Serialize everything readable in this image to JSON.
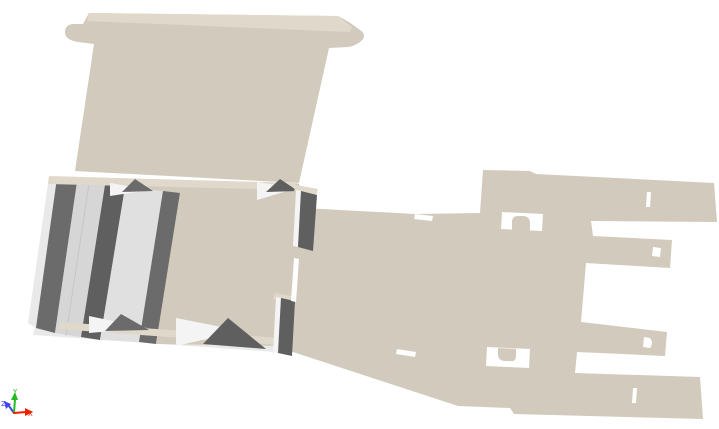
{
  "viewport": {
    "description": "3D visualization viewport showing a partially folded cardboard packaging blank on a white background",
    "background": "#ffffff",
    "object": "cardboard-box-blank-partially-folded"
  },
  "palette": {
    "board": "#d2cabc",
    "edgeBoard": "#e0d9cb",
    "edgeLight": "#e9e9e9",
    "wallDark": "#6b6b6b",
    "wallDark2": "#5f5f5f",
    "floorGray": "#d6d6d6",
    "floorGray2": "#e0e0e0",
    "white": "#ffffff",
    "white2": "#f4f4f4",
    "seam": "#c6c6c6",
    "axisX": "#ee2200",
    "axisY": "#22bb22",
    "axisZ": "#4444ee"
  },
  "axes_widget": {
    "x": {
      "label": "X",
      "color": "#ee2200"
    },
    "y": {
      "label": "Y",
      "color": "#22bb22"
    },
    "z": {
      "label": "Z",
      "color": "#4444ee"
    }
  },
  "scene": {
    "width": 719,
    "height": 429,
    "shapes": [
      {
        "name": "flat-blank",
        "d": "M49,177 L296,183 L299,184 L303,208 L415,214 L480,213 L483,170 L530,171 L536,174 L714,183 L717,222 L591,221 L593,236 L672,240 L670,268 L586,263 L581,322 L667,332 L665,356 L577,352 L575,373 L700,377 L703,419 L514,414 L510,408 L458,406 L293,352 L277,344 L35,327 Z",
        "fill": "$board"
      },
      {
        "name": "panel-front-edge",
        "d": "M35,327 L277,344 L276,352 L33,335 Z",
        "fill": "$edgeLight"
      },
      {
        "name": "slot-top",
        "d": "M415,214 L433,216 L432,221 L414,219 Z",
        "fill": "$white"
      },
      {
        "name": "slot-bottom",
        "d": "M397,349 L416,352 L415,357 L396,354 Z",
        "fill": "$white"
      },
      {
        "name": "window-upper",
        "d": "M502,212 L543,214 L542,231 L501,229 Z",
        "fill": "$white"
      },
      {
        "name": "window-upper-tab",
        "d": "M512,230 L512,222 Q512,216 518,216 L524,216 Q530,217 530,223 L530,231 Z",
        "fill": "$board"
      },
      {
        "name": "window-lower",
        "d": "M487,347 L530,349 L529,368 L486,366 Z",
        "fill": "$white"
      },
      {
        "name": "window-lower-tab",
        "d": "M498,348 L516,349 L516,356 Q516,362 510,361 L504,361 Q498,360 498,354 Z",
        "fill": "$board"
      },
      {
        "name": "slot-prong-top",
        "d": "M647,192 L651,192 L650,207 L646,207 Z",
        "fill": "$white"
      },
      {
        "name": "notch-prong-mid-upper",
        "d": "M653,247 L661,248 L660,257 L652,256 Z",
        "fill": "$white"
      },
      {
        "name": "notch-prong-mid-lower",
        "d": "M644,337 L650,338 Q654,343 650,348 L643,347 Z",
        "fill": "$white"
      },
      {
        "name": "slot-prong-bottom",
        "d": "M633,388 L637,388 L636,403 L632,403 Z",
        "fill": "$white"
      },
      {
        "name": "lid-panel",
        "d": "M75,171 L94,44 L78,42 Q64,40 65,31 Q66,23 77,24 L83,24 L89,13 L333,16 L338,16 Q350,22 360,30 Q366,34 363,39 Q358,45 349,47 L329,48 L299,183 Z",
        "fill": "$board"
      },
      {
        "name": "lid-top-edge",
        "d": "M89,13 L338,16 L352,27 L350,32 L87,21 Z",
        "fill": "$edgeBoard"
      },
      {
        "name": "tray-outer-edge",
        "d": "M49,177 L57,178 L36,328 L28,323 Z",
        "fill": "$edgeLight"
      },
      {
        "name": "tray-outer-wall",
        "d": "M57,178 L77,182 L55,333 L36,328 Z",
        "fill": "$wallDark"
      },
      {
        "name": "tray-floor",
        "d": "M77,182 L105,185 L81,337 L55,333 Z",
        "fill": "$floorGray"
      },
      {
        "name": "tray-floor-seam",
        "d": "M89,184 L66,335",
        "stroke": "$seam",
        "sw": 1
      },
      {
        "name": "tray-wall-mid",
        "d": "M105,185 L125,187 L100,340 L81,337 Z",
        "fill": "$wallDark2"
      },
      {
        "name": "tray-channel",
        "d": "M125,187 L163,191 L139,342 L100,340 Z",
        "fill": "$floorGray2"
      },
      {
        "name": "tray-wall-inner",
        "d": "M163,191 L180,193 L156,344 L139,342 Z",
        "fill": "$wallDark"
      },
      {
        "name": "tray-inner-panel",
        "d": "M180,193 L296,186 L281,346 L156,344 Z",
        "fill": "$board"
      },
      {
        "name": "tray-caps-top",
        "d": "M49,176 L296,183 L295,190 L48,184 Z",
        "fill": "$edgeBoard"
      },
      {
        "name": "tray-caps-bottom",
        "d": "M60,322 L280,338 L279,345 L58,329 Z",
        "fill": "$edgeBoard"
      },
      {
        "name": "gusset-top-left-face",
        "d": "M110,183 L150,190 L110,196 Z",
        "fill": "$white2"
      },
      {
        "name": "gusset-top-left-shadow",
        "d": "M135,179 L153,191 L122,192 Z",
        "fill": "$wallDark"
      },
      {
        "name": "gusset-top-right-face",
        "d": "M257,182 L297,188 L257,200 Z",
        "fill": "$white2"
      },
      {
        "name": "gusset-top-right-shadow",
        "d": "M280,179 L298,191 L266,192 Z",
        "fill": "$wallDark2"
      },
      {
        "name": "gusset-bottom-left-face",
        "d": "M89,316 L147,328 L89,333 Z",
        "fill": "$white2"
      },
      {
        "name": "gusset-bottom-left-shadow",
        "d": "M121,314 L149,330 L105,331 Z",
        "fill": "$wallDark"
      },
      {
        "name": "gusset-bottom-right-face",
        "d": "M176,318 L242,331 L176,346 Z",
        "fill": "$white2"
      },
      {
        "name": "gusset-bottom-right-shadow",
        "d": "M228,318 L266,349 L203,344 Z",
        "fill": "$wallDark2"
      },
      {
        "name": "wall-end-back-cap",
        "d": "M296,185 L318,189 L316,196 L294,191 Z",
        "fill": "$edgeBoard"
      },
      {
        "name": "wall-end-back-lit",
        "d": "M296,190 L301,191 L298,247 L293,246 Z",
        "fill": "$white2"
      },
      {
        "name": "wall-end-back-dark",
        "d": "M301,191 L317,195 L313,251 L298,247 Z",
        "fill": "$wallDark2"
      },
      {
        "name": "wall-end-front-cap",
        "d": "M275,293 L296,297 L294,303 L273,299 Z",
        "fill": "$edgeBoard"
      },
      {
        "name": "wall-end-front-lit",
        "d": "M276,297 L281,298 L278,353 L273,352 Z",
        "fill": "$white2"
      },
      {
        "name": "wall-end-front-dark",
        "d": "M281,298 L295,301 L292,356 L278,353 Z",
        "fill": "$wallDark2"
      },
      {
        "name": "tray-vertical-slot",
        "d": "M294,258 L299,259 L296,302 L291,301 Z",
        "fill": "$white"
      },
      {
        "name": "axis-z-line",
        "d": "M14,413 L9,406",
        "stroke": "$axisZ",
        "sw": 2
      },
      {
        "name": "axis-z-arrowhead",
        "d": "M4,401 L11,404 L6,409 Z",
        "fill": "$axisZ"
      },
      {
        "name": "axis-y-line",
        "d": "M14,413 L15,399",
        "stroke": "$axisY",
        "sw": 2
      },
      {
        "name": "axis-y-arrowhead",
        "d": "M11,400 L18,400 L15,392 Z",
        "fill": "$axisY"
      },
      {
        "name": "axis-x-line",
        "d": "M14,413 L26,412",
        "stroke": "$axisX",
        "sw": 2
      },
      {
        "name": "axis-x-arrowhead",
        "d": "M25,408 L25,416 L33,412 Z",
        "fill": "$axisX"
      }
    ],
    "labels": [
      {
        "name": "axis-y-label",
        "source": "axes_widget.y",
        "x": 13,
        "y": 394,
        "size": 7
      },
      {
        "name": "axis-z-label",
        "source": "axes_widget.z",
        "x": 1,
        "y": 406,
        "size": 7
      },
      {
        "name": "axis-x-label",
        "source": "axes_widget.x",
        "x": 28,
        "y": 416,
        "size": 7
      }
    ]
  }
}
